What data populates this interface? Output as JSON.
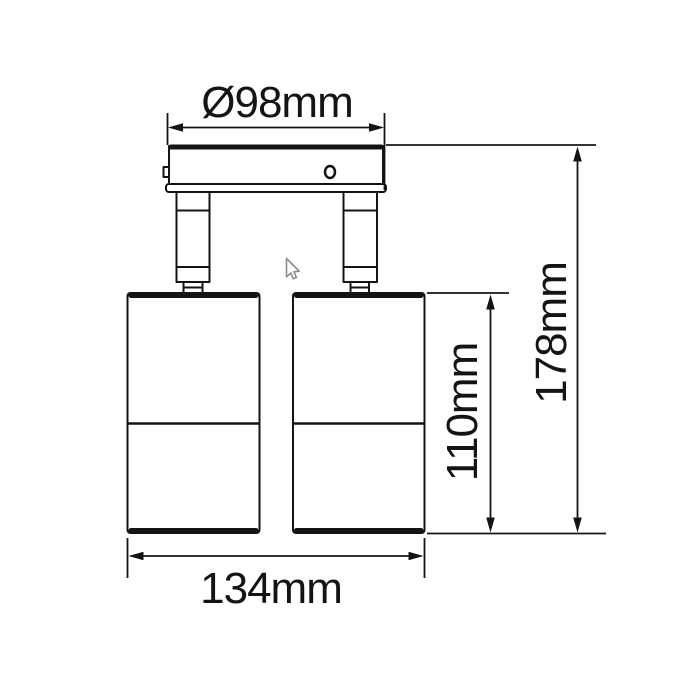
{
  "colors": {
    "line": "#141414",
    "cursor": "#8c8c8c",
    "background": "#ffffff"
  },
  "drawing": {
    "labels": {
      "canopy_diameter": "Ø98mm",
      "overall_height": "178mm",
      "body_height": "110mm",
      "overall_width": "134mm"
    }
  }
}
